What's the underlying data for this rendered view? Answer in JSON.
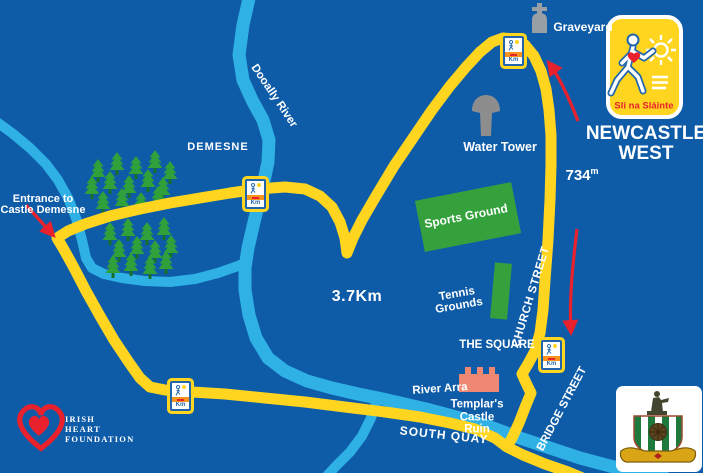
{
  "title": {
    "line1": "NEWCASTLE",
    "line2": "WEST"
  },
  "logo": {
    "name": "Slí na Sláinte",
    "text": "Slí na Sláinte"
  },
  "labels": {
    "graveyard": "Graveyard",
    "demesne": "DEMESNE",
    "entrance_line1": "Entrance to",
    "entrance_line2": "Castle Demesne",
    "dooally_river": "Dooally River",
    "water_tower": "Water Tower",
    "sports_ground": "Sports Ground",
    "tennis_line1": "Tennis",
    "tennis_line2": "Grounds",
    "church_street": "CHURCH STREET",
    "the_square": "THE SQUARE",
    "templars_line1": "Templar's",
    "templars_line2": "Castle",
    "templars_line3": "Ruin",
    "bridge_street": "BRIDGE STREET",
    "river_arra": "River Arra",
    "south_quay": "SOUTH QUAY"
  },
  "route": {
    "total_distance": "3.7Km",
    "segment_distance_value": "734",
    "segment_distance_unit": "m"
  },
  "km_marker": {
    "label": "Km"
  },
  "footer": {
    "ihf_line1": "IRISH",
    "ihf_line2": "HEART",
    "ihf_line3": "FOUNDATION"
  },
  "colors": {
    "background": "#0e5ca8",
    "route_yellow": "#ffd520",
    "river_blue": "#30b1e6",
    "ground_green": "#35a13d",
    "tree_green": "#2fa03a",
    "accent_red": "#e8212d",
    "castle_salmon": "#ee8873",
    "stone_gray": "#98a0a6",
    "text_white": "#ffffff"
  }
}
